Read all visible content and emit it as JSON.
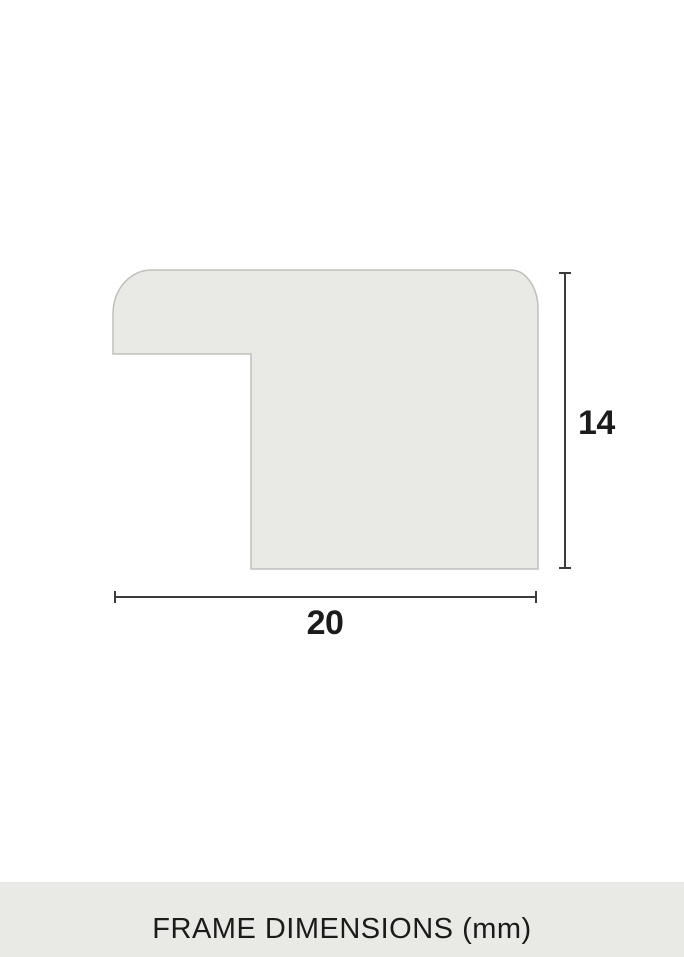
{
  "diagram": {
    "height_label": "14",
    "width_label": "20",
    "caption": "FRAME DIMENSIONS (mm)"
  },
  "colors": {
    "background": "#ffffff",
    "shape_fill": "#e9e9e6",
    "shape_stroke": "#bfbfbb",
    "dim_line": "#3c3c3c",
    "label_text": "#1b1b19",
    "caption_bg": "#e9e9e6",
    "caption_text": "#1b1b19"
  }
}
